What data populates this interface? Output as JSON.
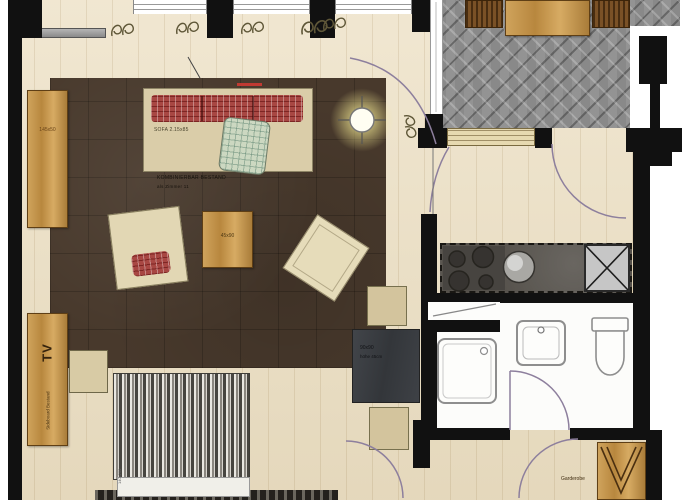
{
  "title": "apartment-floor-plan",
  "labels": {
    "cabinet_size": "145x50",
    "sofa": "SOFA 2.15x85",
    "note_line1": "KOMBINIERBAR BESTAND",
    "note_line2": "als Zimmer 11",
    "coffee_table_size": "45x90",
    "table_size": "90x90",
    "table_note": "höhe 45cm",
    "tv": "TV",
    "tv_note": "Sideboard Bestand",
    "bed_size": "140x200",
    "wardrobe": "Garderobe"
  },
  "colors": {
    "wall": "#111111",
    "floor_wood": "#ecdfc2",
    "rug": "#48392c",
    "furniture_wood": "#c2914c",
    "terrace_paving": "#8f8f8f",
    "sofa_red": "#a84743",
    "pillow_green": "#ccd8c1",
    "door_arc": "#8d7f9d",
    "lamp_glow": "#f3eca8",
    "kitchen_counter": "#55514b",
    "bed_stripe_dark": "#474540",
    "bathroom": "#fcfcfa"
  }
}
